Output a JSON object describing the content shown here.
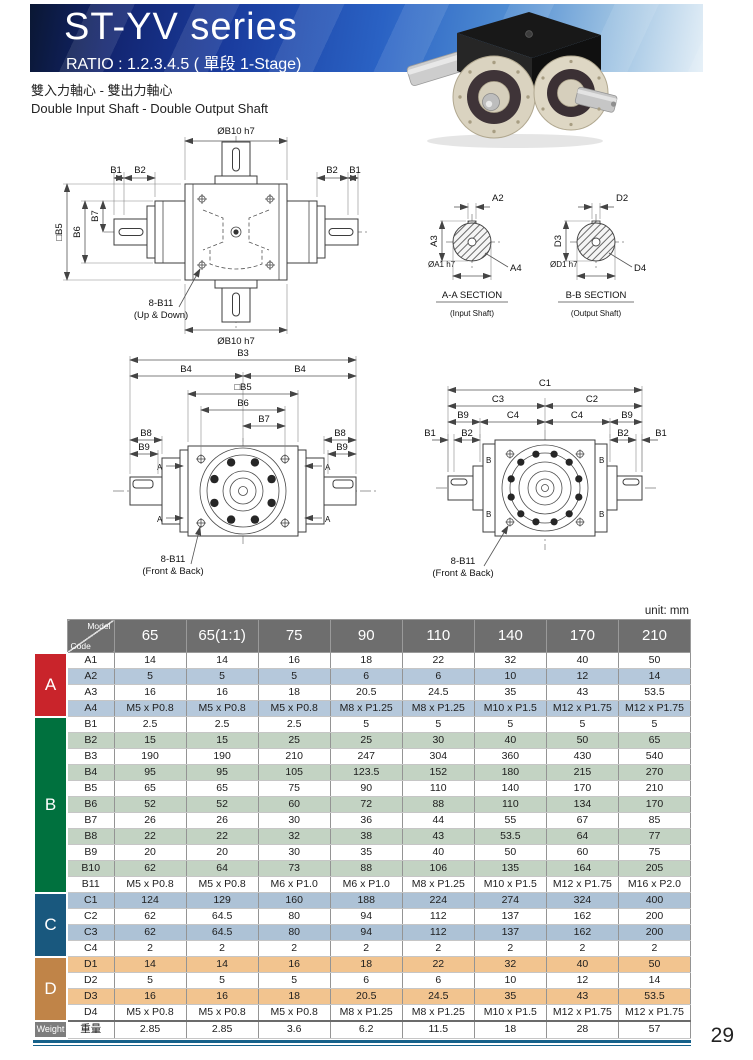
{
  "header": {
    "title": "ST-YV series",
    "ratio": "RATIO : 1.2.3.4.5 ( 單段 1-Stage)",
    "tagline_zh": "雙入力軸心 - 雙出力軸心",
    "tagline_en": "Double Input Shaft - Double Output Shaft"
  },
  "labels": {
    "b1": "B1",
    "b2": "B2",
    "b3": "B3",
    "b4": "B4",
    "sq_b5": "□B5",
    "b6": "B6",
    "b7": "B7",
    "b8": "B8",
    "b9": "B9",
    "dia_b10": "ØB10 h7",
    "bolt8": "8-B11",
    "up_down": "(Up & Down)",
    "front_back": "(Front & Back)",
    "a2": "A2",
    "a3": "A3",
    "a4": "A4",
    "dia_a1": "ØA1 h7",
    "aa_sec": "A-A SECTION",
    "aa_sub": "(Input Shaft)",
    "d2": "D2",
    "d3": "D3",
    "d4": "D4",
    "dia_d1": "ØD1 h7",
    "bb_sec": "B-B SECTION",
    "bb_sub": "(Output Shaft)",
    "c1": "C1",
    "c2": "C2",
    "c3": "C3",
    "c4": "C4",
    "a_mark": "A",
    "b_mark": "B"
  },
  "table": {
    "unit": "unit: mm",
    "corner_top": "Model",
    "corner_bottom": "Code",
    "header_bg": "#6e6e6e",
    "columns": [
      "65",
      "65(1:1)",
      "75",
      "90",
      "110",
      "140",
      "170",
      "210"
    ],
    "groups": [
      {
        "label": "A",
        "color": "#c9242b",
        "stripe": "#b5c8db",
        "rows": [
          {
            "code": "A1",
            "values": [
              "14",
              "14",
              "16",
              "18",
              "22",
              "32",
              "40",
              "50"
            ]
          },
          {
            "code": "A2",
            "values": [
              "5",
              "5",
              "5",
              "6",
              "6",
              "10",
              "12",
              "14"
            ]
          },
          {
            "code": "A3",
            "values": [
              "16",
              "16",
              "18",
              "20.5",
              "24.5",
              "35",
              "43",
              "53.5"
            ]
          },
          {
            "code": "A4",
            "values": [
              "M5 x P0.8",
              "M5 x P0.8",
              "M5 x P0.8",
              "M8 x P1.25",
              "M8 x P1.25",
              "M10 x P1.5",
              "M12 x P1.75",
              "M12 x P1.75"
            ]
          }
        ]
      },
      {
        "label": "B",
        "color": "#00713e",
        "stripe": "#c3d3c3",
        "rows": [
          {
            "code": "B1",
            "values": [
              "2.5",
              "2.5",
              "2.5",
              "5",
              "5",
              "5",
              "5",
              "5"
            ]
          },
          {
            "code": "B2",
            "values": [
              "15",
              "15",
              "25",
              "25",
              "30",
              "40",
              "50",
              "65"
            ]
          },
          {
            "code": "B3",
            "values": [
              "190",
              "190",
              "210",
              "247",
              "304",
              "360",
              "430",
              "540"
            ]
          },
          {
            "code": "B4",
            "values": [
              "95",
              "95",
              "105",
              "123.5",
              "152",
              "180",
              "215",
              "270"
            ]
          },
          {
            "code": "B5",
            "values": [
              "65",
              "65",
              "75",
              "90",
              "110",
              "140",
              "170",
              "210"
            ]
          },
          {
            "code": "B6",
            "values": [
              "52",
              "52",
              "60",
              "72",
              "88",
              "110",
              "134",
              "170"
            ]
          },
          {
            "code": "B7",
            "values": [
              "26",
              "26",
              "30",
              "36",
              "44",
              "55",
              "67",
              "85"
            ]
          },
          {
            "code": "B8",
            "values": [
              "22",
              "22",
              "32",
              "38",
              "43",
              "53.5",
              "64",
              "77"
            ]
          },
          {
            "code": "B9",
            "values": [
              "20",
              "20",
              "30",
              "35",
              "40",
              "50",
              "60",
              "75"
            ]
          },
          {
            "code": "B10",
            "values": [
              "62",
              "64",
              "73",
              "88",
              "106",
              "135",
              "164",
              "205"
            ]
          },
          {
            "code": "B11",
            "values": [
              "M5 x P0.8",
              "M5 x P0.8",
              "M6 x P1.0",
              "M6 x P1.0",
              "M8 x P1.25",
              "M10 x P1.5",
              "M12 x P1.75",
              "M16 x P2.0"
            ]
          }
        ]
      },
      {
        "label": "C",
        "color": "#19587e",
        "stripe": "#adc2d6",
        "rows": [
          {
            "code": "C1",
            "values": [
              "124",
              "129",
              "160",
              "188",
              "224",
              "274",
              "324",
              "400"
            ]
          },
          {
            "code": "C2",
            "values": [
              "62",
              "64.5",
              "80",
              "94",
              "112",
              "137",
              "162",
              "200"
            ]
          },
          {
            "code": "C3",
            "values": [
              "62",
              "64.5",
              "80",
              "94",
              "112",
              "137",
              "162",
              "200"
            ]
          },
          {
            "code": "C4",
            "values": [
              "2",
              "2",
              "2",
              "2",
              "2",
              "2",
              "2",
              "2"
            ]
          }
        ]
      },
      {
        "label": "D",
        "color": "#c08448",
        "stripe": "#f2c48f",
        "rows": [
          {
            "code": "D1",
            "values": [
              "14",
              "14",
              "16",
              "18",
              "22",
              "32",
              "40",
              "50"
            ]
          },
          {
            "code": "D2",
            "values": [
              "5",
              "5",
              "5",
              "6",
              "6",
              "10",
              "12",
              "14"
            ]
          },
          {
            "code": "D3",
            "values": [
              "16",
              "16",
              "18",
              "20.5",
              "24.5",
              "35",
              "43",
              "53.5"
            ]
          },
          {
            "code": "D4",
            "values": [
              "M5 x P0.8",
              "M5 x P0.8",
              "M5 x P0.8",
              "M8 x P1.25",
              "M8 x P1.25",
              "M10 x P1.5",
              "M12 x P1.75",
              "M12 x P1.75"
            ]
          }
        ]
      }
    ],
    "weight": {
      "label": "Weight",
      "color": "#7d7d7d",
      "code": "重量",
      "values": [
        "2.85",
        "2.85",
        "3.6",
        "6.2",
        "11.5",
        "18",
        "28",
        "57"
      ]
    }
  },
  "page": {
    "number": "29"
  },
  "colors": {
    "rule_teal": "#16618a",
    "banner_navy": "#0a1733",
    "banner_blue": "#2a62c4"
  }
}
